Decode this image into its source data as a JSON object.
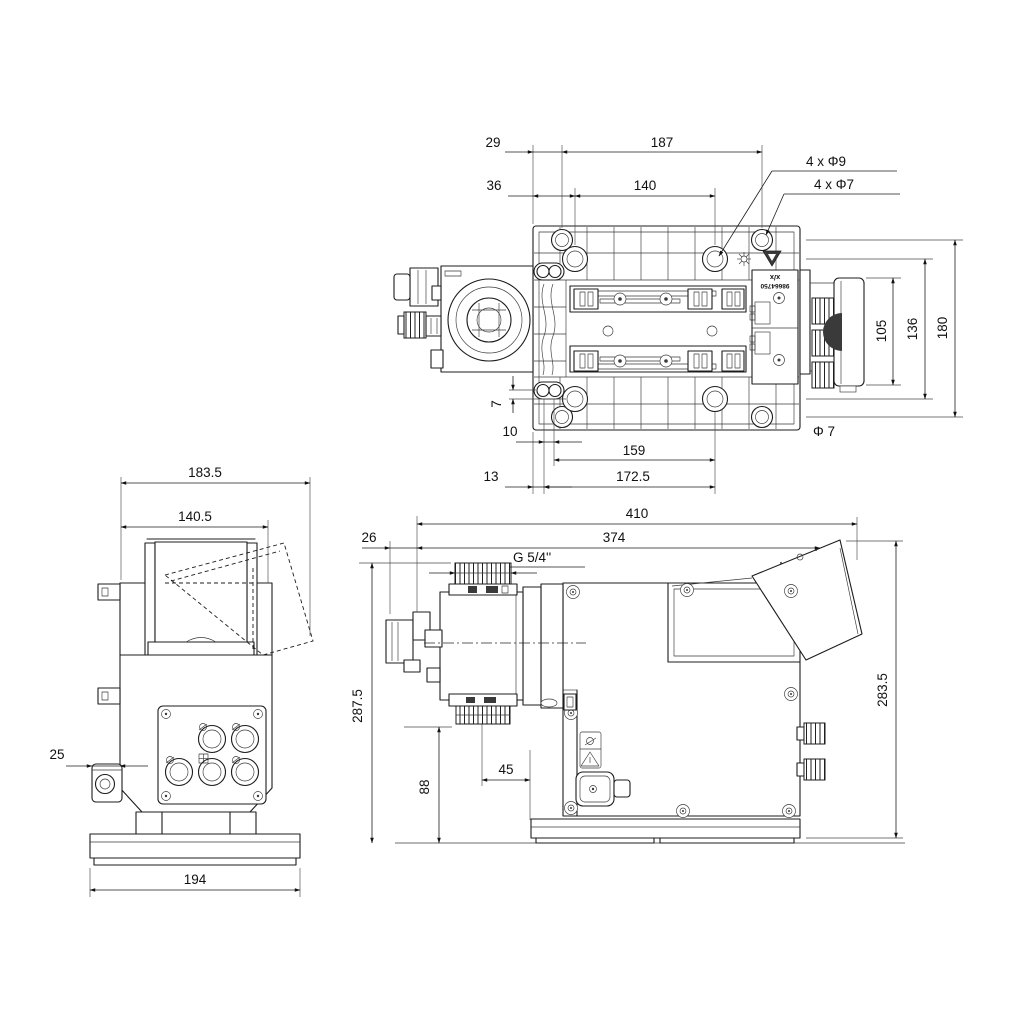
{
  "top_view": {
    "dim_29": "29",
    "dim_187": "187",
    "dim_36": "36",
    "dim_140": "140",
    "callout_phi9": "4 x Φ9",
    "callout_phi7": "4 x Φ7",
    "dim_105": "105",
    "dim_136": "136",
    "dim_180": "180",
    "dim_7": "7",
    "dim_10": "10",
    "dim_159": "159",
    "label_phi7": "Φ 7",
    "dim_13": "13",
    "dim_172_5": "172.5",
    "nameplate": {
      "line1": "x/x",
      "line2": "98664750"
    }
  },
  "front_view": {
    "dim_183_5": "183.5",
    "dim_140_5": "140.5",
    "dim_25": "25",
    "dim_194": "194"
  },
  "side_view": {
    "dim_26": "26",
    "dim_410": "410",
    "dim_374": "374",
    "thread_label": "G 5/4''",
    "dim_287_5": "287.5",
    "dim_283_5": "283.5",
    "dim_88": "88",
    "dim_45": "45"
  }
}
